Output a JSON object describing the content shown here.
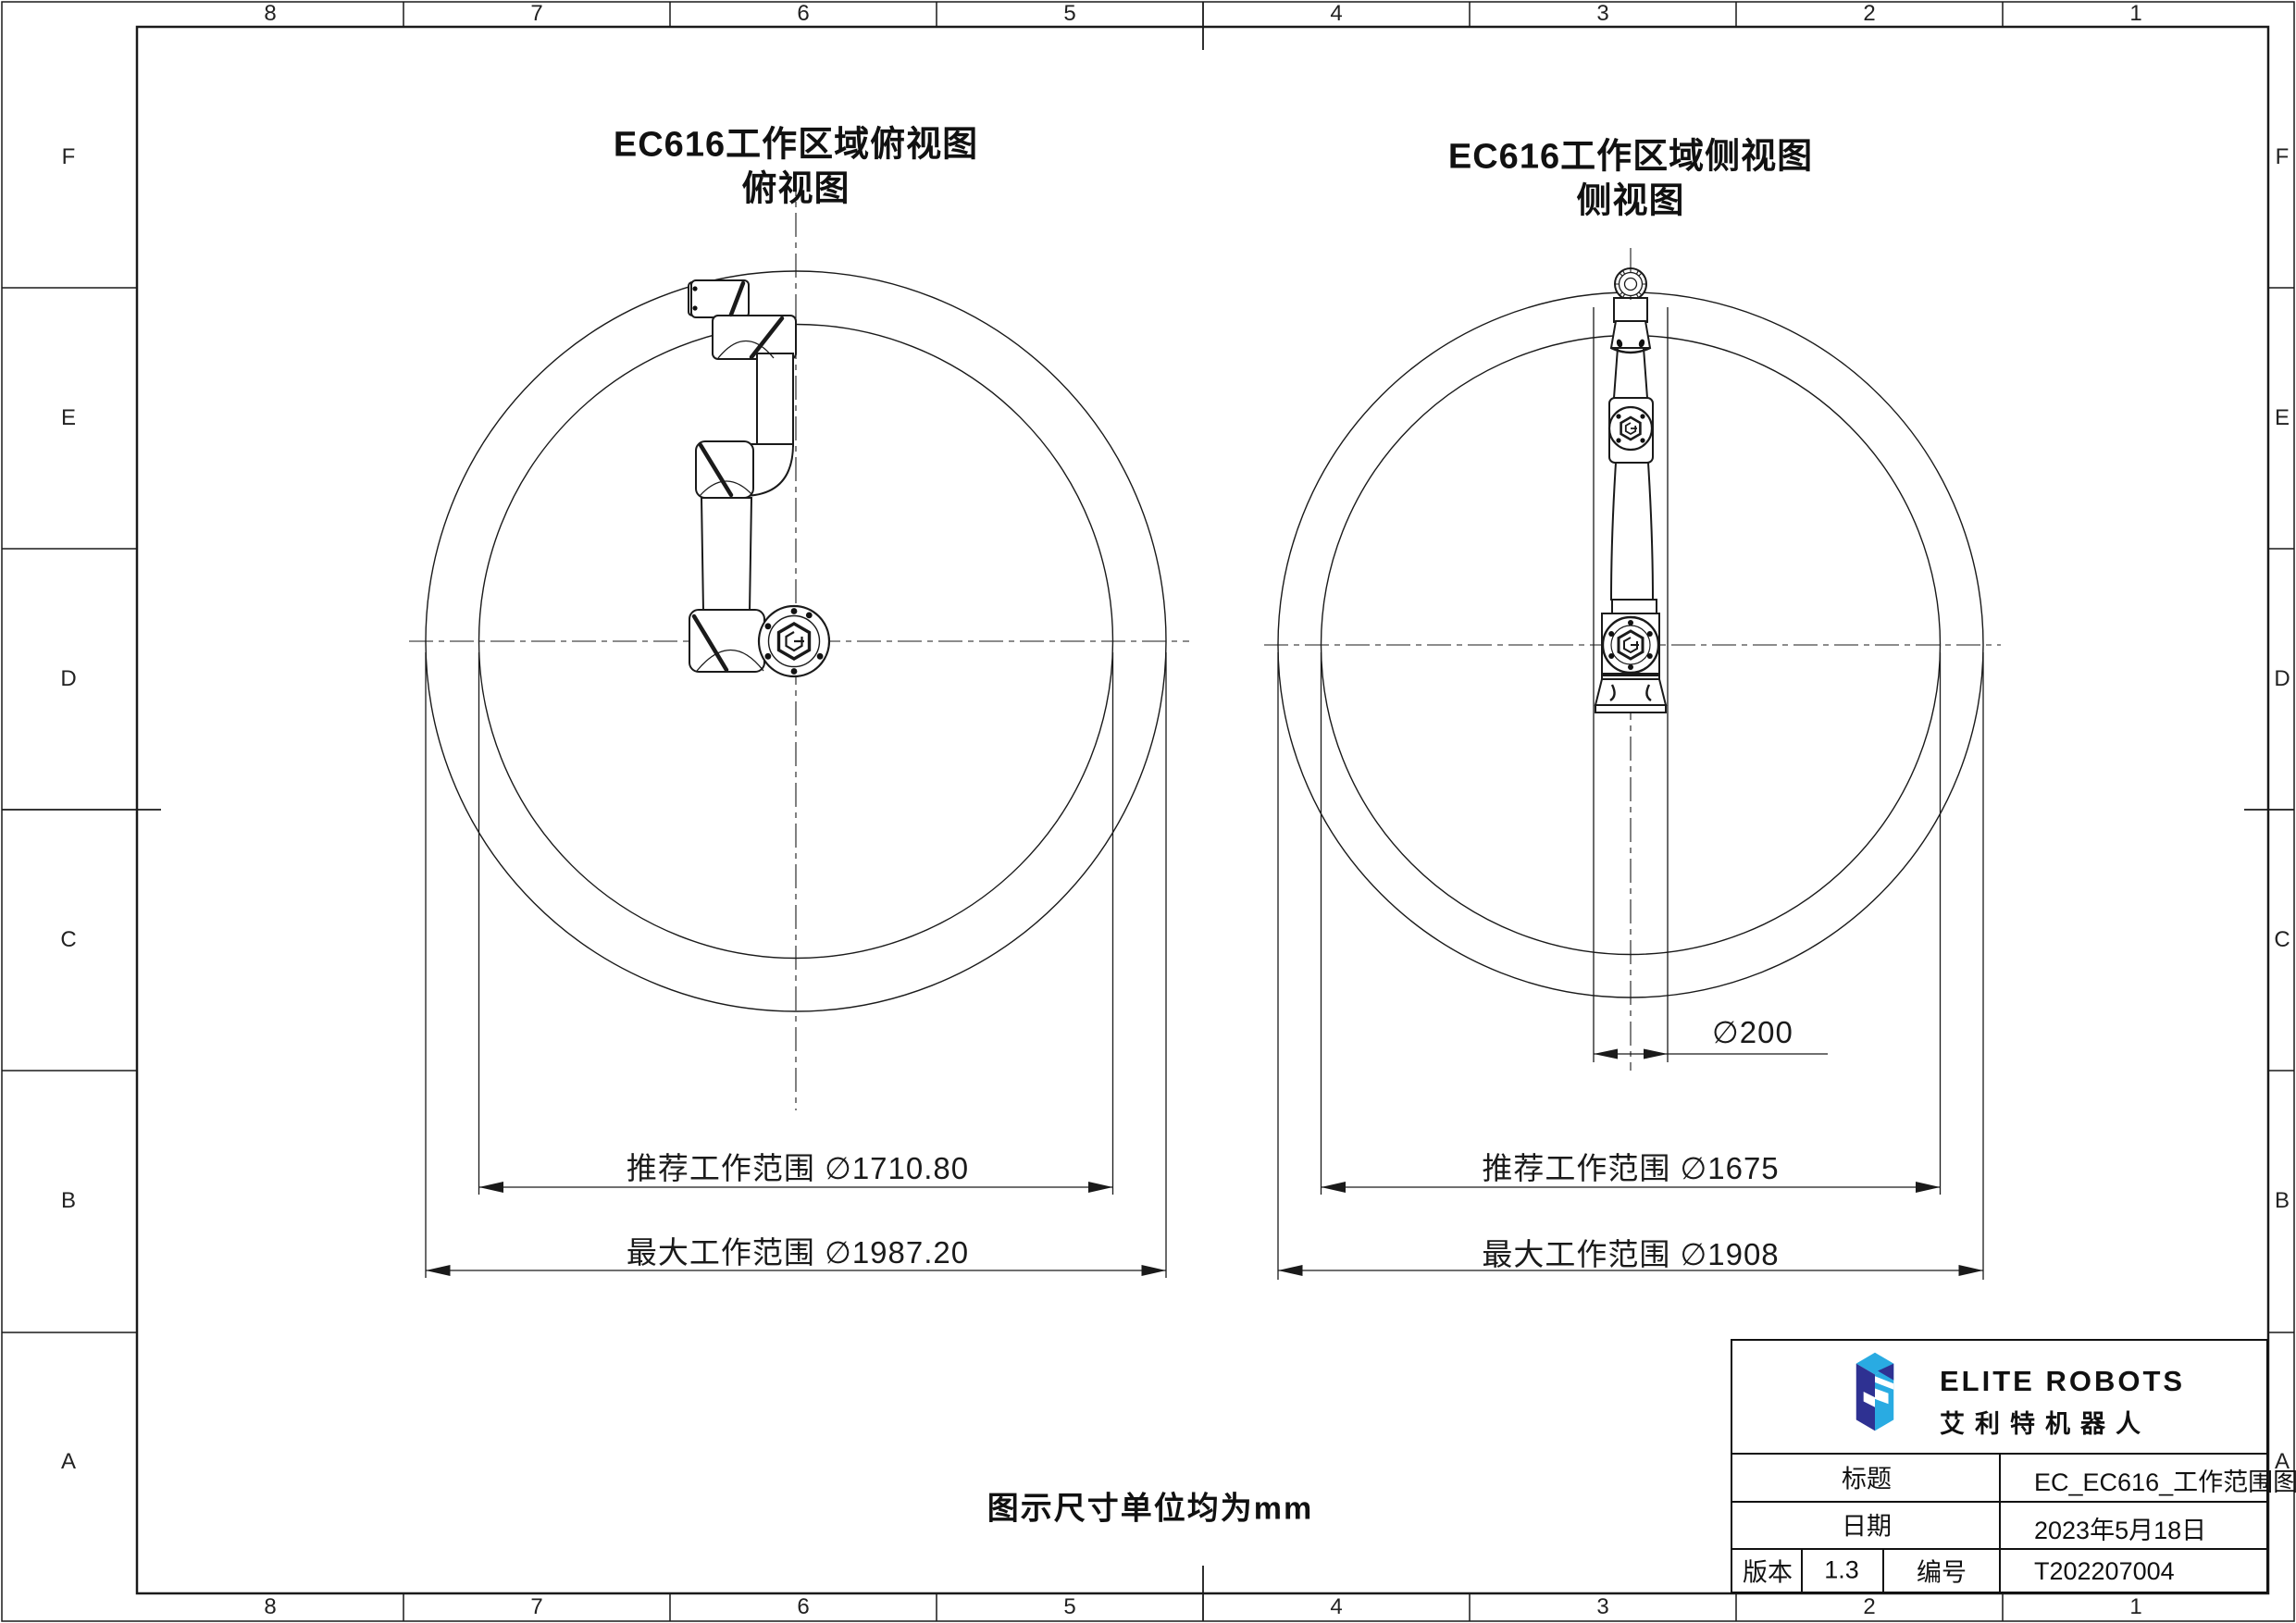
{
  "sheet": {
    "grid_columns": [
      "8",
      "7",
      "6",
      "5",
      "4",
      "3",
      "2",
      "1"
    ],
    "grid_rows": [
      "F",
      "E",
      "D",
      "C",
      "B",
      "A"
    ],
    "unit_note": "图示尺寸单位均为mm"
  },
  "top_view": {
    "title_line1": "EC616工作区域俯视图",
    "title_line2": "俯视图",
    "dim_recommended": "推荐工作范围 ∅1710.80",
    "dim_max": "最大工作范围 ∅1987.20"
  },
  "side_view": {
    "title_line1": "EC616工作区域侧视图",
    "title_line2": "侧视图",
    "dim_recommended": "推荐工作范围 ∅1675",
    "dim_max": "最大工作范围 ∅1908",
    "dim_column": "∅200"
  },
  "title_block": {
    "brand_en": "ELITE ROBOTS",
    "brand_cn": "艾利特机器人",
    "title_label": "标题",
    "title_value": "EC_EC616_工作范围图",
    "date_label": "日期",
    "date_value": "2023年5月18日",
    "version_label": "版本",
    "version_value": "1.3",
    "number_label": "编号",
    "number_value": "T202207004"
  },
  "colors": {
    "line": "#1a1a1a",
    "logo_navy": "#2E3192",
    "logo_blue": "#29ABE2"
  }
}
